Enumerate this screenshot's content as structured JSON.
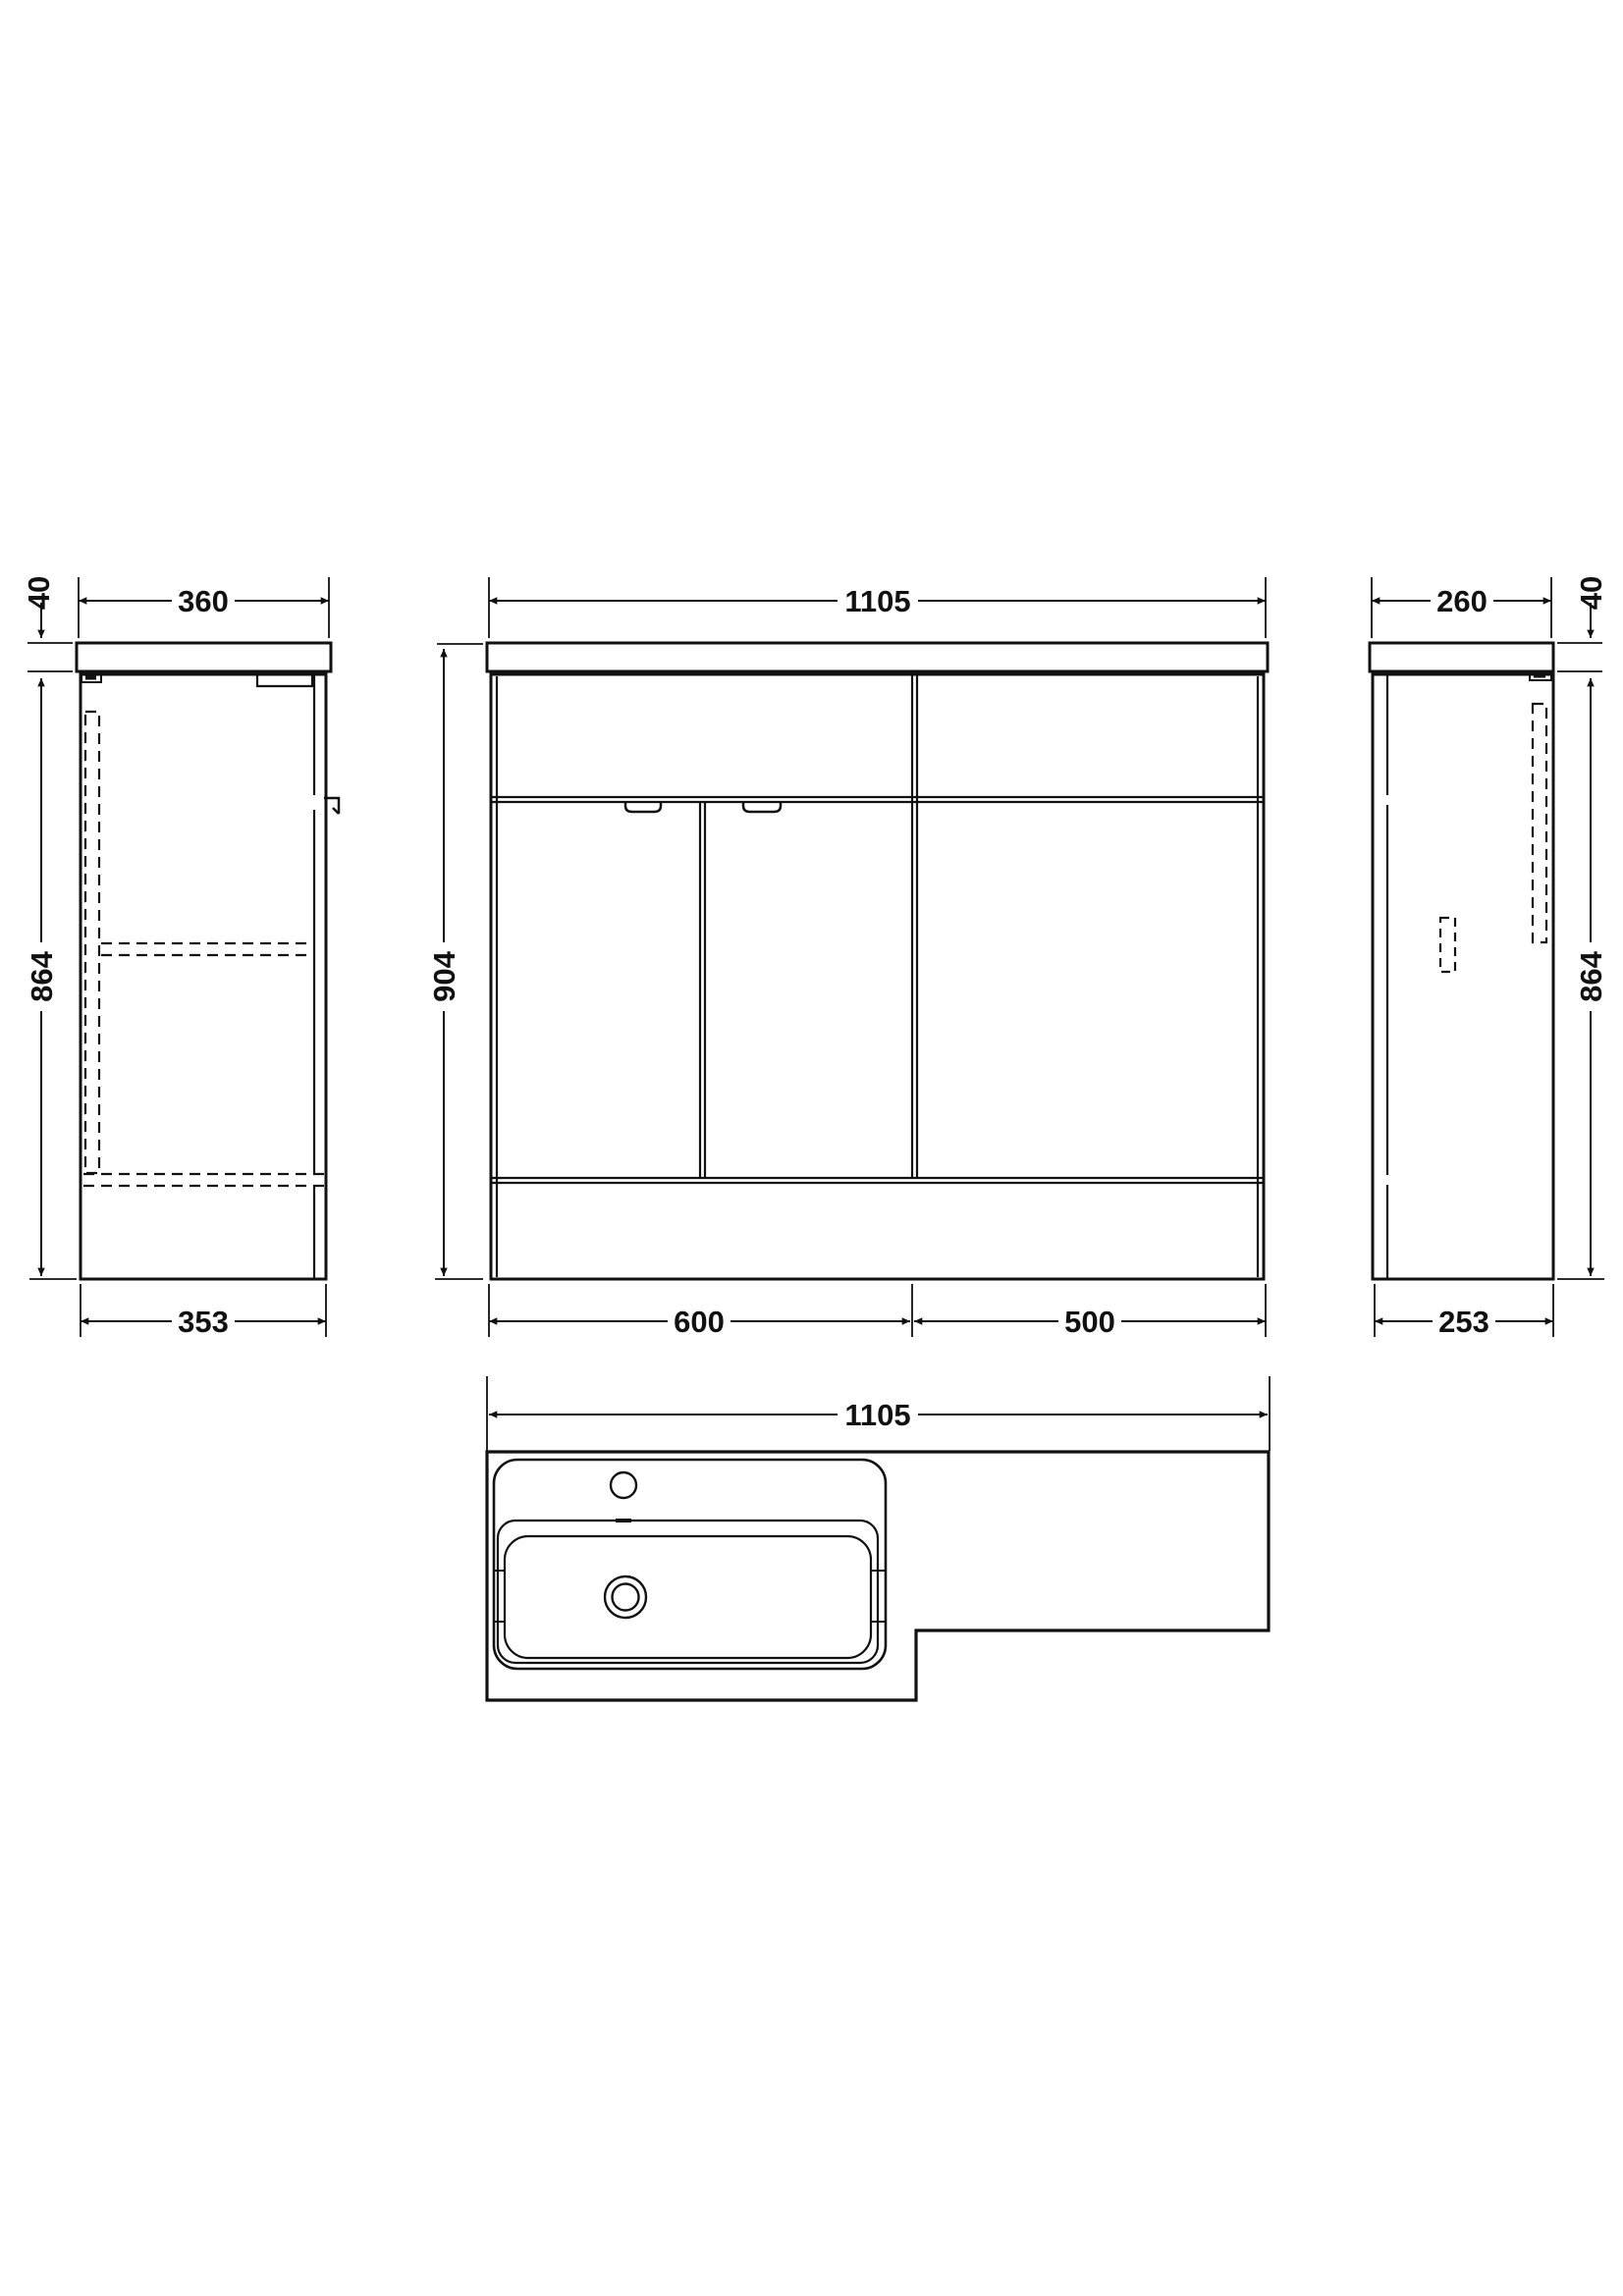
{
  "drawing": {
    "type": "bathroom furniture unit technical drawing",
    "line_color": "#111111",
    "background_color": "#ffffff",
    "dimensions": {
      "side_left": {
        "width_top": "360",
        "countertop_thickness": "40",
        "height": "864",
        "width_bottom": "353"
      },
      "front": {
        "width_top": "1105",
        "height": "904",
        "vanity_width_bottom": "600",
        "wc_width_bottom": "500"
      },
      "side_right": {
        "width_top": "260",
        "countertop_thickness": "40",
        "height": "864",
        "width_bottom": "253"
      },
      "plan": {
        "width_top": "1105"
      }
    }
  }
}
